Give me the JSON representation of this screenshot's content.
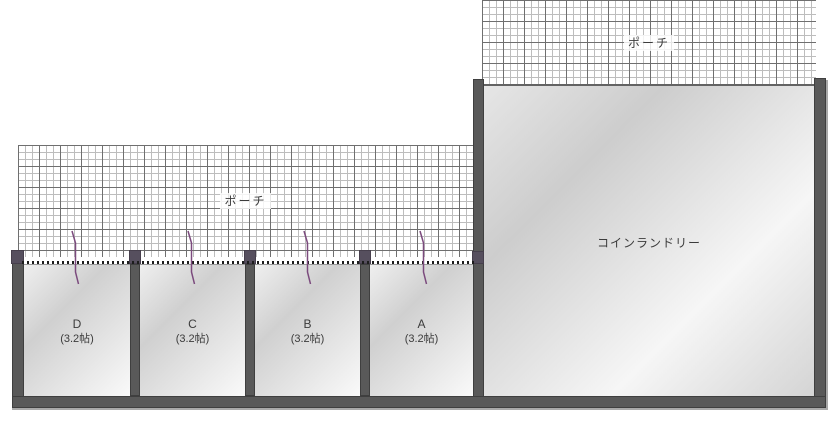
{
  "title": "floor-plan",
  "colors": {
    "wall": "#595959",
    "cap": "#564f5e",
    "arrow": "#7b4a7d",
    "hatch-line": "#6f6f6f",
    "hatch-line-light": "#bdbdbd",
    "dotted": "#1c1c1c",
    "label": "#3c3c3c",
    "bevel": "#a9a9a9"
  },
  "porch_upper": {
    "label": "ポーチ"
  },
  "porch_lower": {
    "label": "ポーチ"
  },
  "laundry": {
    "label": "コインランドリー"
  },
  "rooms": [
    {
      "name": "D",
      "size": "(3.2帖)"
    },
    {
      "name": "C",
      "size": "(3.2帖)"
    },
    {
      "name": "B",
      "size": "(3.2帖)"
    },
    {
      "name": "A",
      "size": "(3.2帖)"
    }
  ],
  "icons": {
    "entry_arrow": "zigzag-entry-arrow-down"
  }
}
